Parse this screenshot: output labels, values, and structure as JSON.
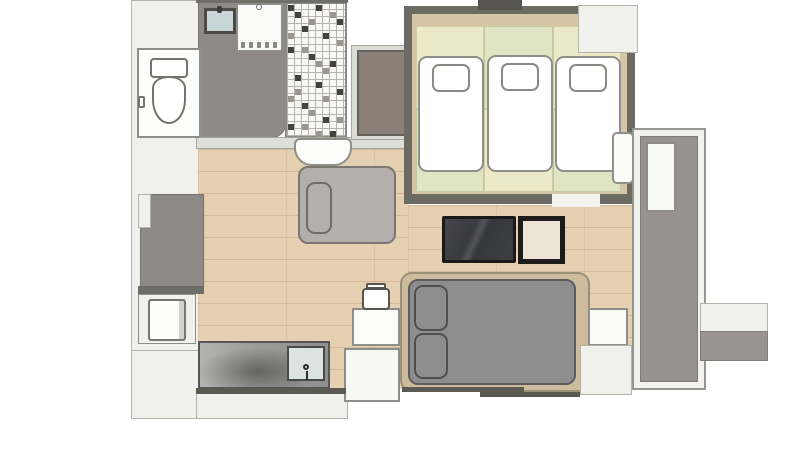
{
  "document": {
    "kind": "apartment-floor-plan",
    "visible_text": [],
    "rooms": [
      {
        "name": "toilet-room",
        "floor": "white",
        "furniture": [
          "toilet"
        ]
      },
      {
        "name": "washroom",
        "floor": "gray-vinyl",
        "furniture": [
          "vanity-sink",
          "washing-machine"
        ]
      },
      {
        "name": "bathroom",
        "floor": "mosaic-tile",
        "furniture": [
          "washbasin"
        ]
      },
      {
        "name": "closet",
        "floor": "gray-brown",
        "furniture": []
      },
      {
        "name": "tatami-bedroom",
        "floor": "tatami-mats",
        "furniture": [
          "futon-1",
          "futon-2",
          "futon-3",
          "air-conditioner"
        ],
        "details": {
          "futon_count": 3,
          "window": "top"
        }
      },
      {
        "name": "living-room",
        "floor": "wood-plank",
        "furniture": [
          "sofa-bed",
          "tv",
          "side-table",
          "double-bed",
          "nightstand",
          "kettle-table",
          "kettle",
          "step-block"
        ]
      },
      {
        "name": "kitchenette",
        "floor": "wood-plank",
        "furniture": [
          "kitchen-counter",
          "kitchen-sink",
          "faucet",
          "mini-fridge"
        ]
      },
      {
        "name": "entrance",
        "floor": "gray",
        "furniture": []
      },
      {
        "name": "balcony",
        "floor": "gray-concrete",
        "furniture": [
          "bench"
        ]
      }
    ],
    "colors": {
      "page_background": "#ffffff",
      "exterior_mass": "#f0f1ec",
      "wall_light": "#dfdfda",
      "wall_dark": "#5a5952",
      "wood_floor": "#e6d0b2",
      "gray_floor": "#8e8a86",
      "tile_white": "#f7f7f4",
      "tile_dark": "#44423d",
      "tile_gray": "#9b978f",
      "tatami_yellow": "#ece9c9",
      "tatami_green": "#dfe5c3",
      "tatami_border_tan": "#d7c5a5",
      "tatami_wall_dark": "#6b6a63",
      "futon_white": "#ffffff",
      "sofa_bed_gray": "#b4afac",
      "tv_screen": "#3e3f42",
      "side_table_cream": "#ece5d6",
      "bed_frame_tan": "#cdbb9b",
      "bed_mattress_gray": "#8d8d8d",
      "counter_steel": "#9b9b99",
      "sink_blue": "#dce4e1",
      "closet_brown": "#8b8077",
      "balcony_floor": "#97938e"
    }
  }
}
